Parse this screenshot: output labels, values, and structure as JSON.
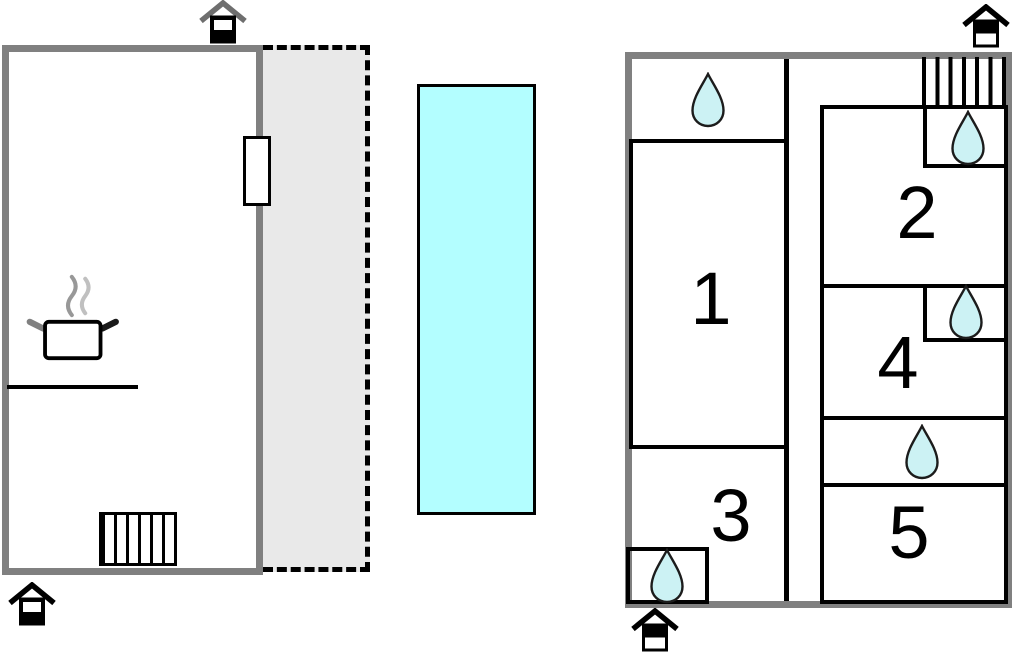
{
  "plan": {
    "rooms": [
      {
        "number": "1"
      },
      {
        "number": "2"
      },
      {
        "number": "3"
      },
      {
        "number": "4"
      },
      {
        "number": "5"
      }
    ],
    "colors": {
      "wall_gray": "#808080",
      "interior_line": "#000000",
      "pool_fill": "#b3feff",
      "terrace_fill": "#e9e9e9",
      "water_drop_fill": "#ccf2f4"
    },
    "icons": {
      "water_drop": "water-drop-icon",
      "entrance": "entrance-house-icon",
      "stairs": "stairs-icon",
      "kitchen": "cooking-pot-icon"
    }
  }
}
